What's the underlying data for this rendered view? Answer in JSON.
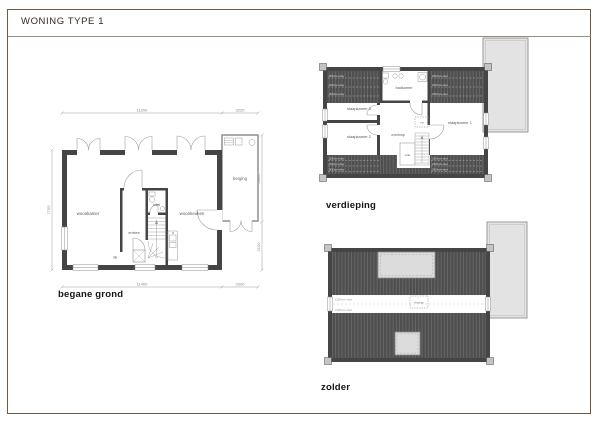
{
  "sheet": {
    "title": "WONING TYPE 1",
    "colors": {
      "frame": "#6e5a40",
      "wall": "#454545",
      "roof_hatch": "#4f4f4f",
      "roof_stripe": "#6a6a6a",
      "neighbor_panel": "#e3e3e3",
      "title_text": "#3a241a"
    }
  },
  "floors": {
    "begane_grond": {
      "label": "begane grond",
      "rooms": {
        "woonkamer": "woonkamer",
        "woonkeuken": "woonkeuken",
        "entree": "entree",
        "toilet": "toilet",
        "mk": "mk",
        "berging": "berging"
      },
      "dims": {
        "top_main": "11200",
        "top_berging": "3220",
        "bottom_main": "11400",
        "bottom_berging": "2000",
        "left": "7700",
        "right_upper": "5000",
        "right_lower": "2100"
      }
    },
    "verdieping": {
      "label": "verdieping",
      "rooms": {
        "slaapkamer1": "slaapkamer 1",
        "slaapkamer2": "slaapkamer 2",
        "slaapkamer3": "slaapkamer 3",
        "badkamer": "badkamer",
        "overloop": "overloop",
        "vide": "vide",
        "mv": "mv"
      },
      "height_lines": {
        "l1": "2600mm+vloer",
        "l2": "2200mm+vloer",
        "l3": "1500mm+vloer"
      }
    },
    "zolder": {
      "label": "zolder",
      "vlizotrap": "vlizotrap",
      "height_lines": {
        "l1": "1500mm+vloer",
        "l2": "1500mm+vloer"
      }
    }
  }
}
